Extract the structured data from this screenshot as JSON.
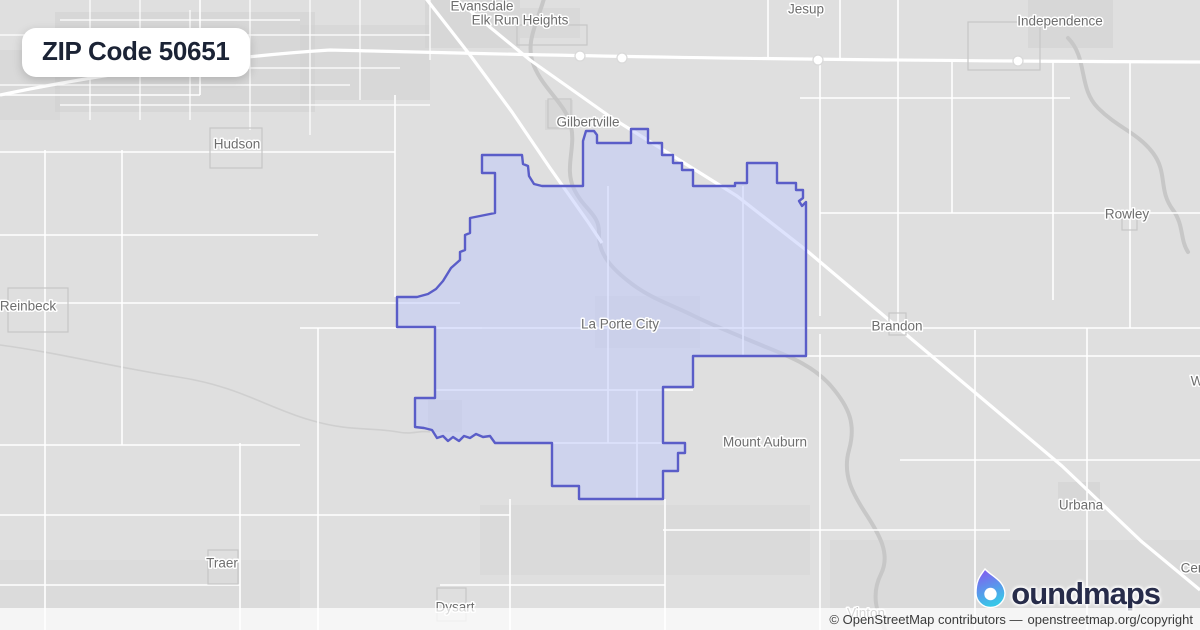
{
  "badge": {
    "title": "ZIP Code 50651"
  },
  "attribution": {
    "text": "© OpenStreetMap contributors —",
    "link": "openstreetmap.org/copyright"
  },
  "logo": {
    "brand": "boundmaps",
    "wordmark_rest": "oundmaps"
  },
  "map_data": {
    "colors": {
      "background": "#dfdfdf",
      "road": "#ffffff",
      "river": "#c7c7c7",
      "creek": "#cfcfcf",
      "town_outline": "#c6c6c6",
      "label": "#6e6e6e",
      "zip_fill": "#bec8fc",
      "zip_stroke": "#5a5dc8",
      "logo_navy": "#272c4a",
      "logo_purple": "#8a53f0",
      "logo_cyan": "#38c6e8"
    },
    "zip_boundary": {
      "name": "ZIP 50651 boundary",
      "fill_opacity": 0.5,
      "stroke_width": 2.4,
      "points": [
        [
          482,
          155
        ],
        [
          522,
          155
        ],
        [
          523,
          164
        ],
        [
          528,
          166
        ],
        [
          529,
          176
        ],
        [
          534,
          184
        ],
        [
          542,
          186
        ],
        [
          583,
          186
        ],
        [
          583,
          141
        ],
        [
          586,
          131
        ],
        [
          594,
          131
        ],
        [
          597,
          135
        ],
        [
          597,
          143
        ],
        [
          631,
          143
        ],
        [
          631,
          129
        ],
        [
          648,
          129
        ],
        [
          648,
          143
        ],
        [
          662,
          143
        ],
        [
          662,
          155
        ],
        [
          673,
          155
        ],
        [
          673,
          163
        ],
        [
          682,
          163
        ],
        [
          682,
          170
        ],
        [
          693,
          170
        ],
        [
          693,
          186
        ],
        [
          735,
          186
        ],
        [
          735,
          183
        ],
        [
          747,
          183
        ],
        [
          747,
          163
        ],
        [
          777,
          163
        ],
        [
          777,
          183
        ],
        [
          796,
          183
        ],
        [
          796,
          190
        ],
        [
          803,
          190
        ],
        [
          803,
          198
        ],
        [
          799,
          201
        ],
        [
          802,
          206
        ],
        [
          806,
          202
        ],
        [
          806,
          356
        ],
        [
          693,
          356
        ],
        [
          693,
          387
        ],
        [
          663,
          387
        ],
        [
          663,
          443
        ],
        [
          685,
          443
        ],
        [
          685,
          453
        ],
        [
          678,
          453
        ],
        [
          678,
          471
        ],
        [
          663,
          471
        ],
        [
          663,
          499
        ],
        [
          579,
          499
        ],
        [
          579,
          486
        ],
        [
          552,
          486
        ],
        [
          552,
          443
        ],
        [
          495,
          443
        ],
        [
          490,
          436
        ],
        [
          483,
          437
        ],
        [
          476,
          434
        ],
        [
          470,
          438
        ],
        [
          464,
          436
        ],
        [
          459,
          441
        ],
        [
          453,
          437
        ],
        [
          448,
          441
        ],
        [
          443,
          436
        ],
        [
          437,
          438
        ],
        [
          432,
          430
        ],
        [
          424,
          428
        ],
        [
          415,
          427
        ],
        [
          415,
          398
        ],
        [
          435,
          398
        ],
        [
          435,
          327
        ],
        [
          397,
          327
        ],
        [
          397,
          297
        ],
        [
          417,
          297
        ],
        [
          428,
          294
        ],
        [
          436,
          289
        ],
        [
          443,
          281
        ],
        [
          451,
          268
        ],
        [
          460,
          260
        ],
        [
          460,
          252
        ],
        [
          465,
          250
        ],
        [
          465,
          235
        ],
        [
          470,
          233
        ],
        [
          470,
          218
        ],
        [
          495,
          213
        ],
        [
          495,
          173
        ],
        [
          482,
          173
        ]
      ]
    },
    "labels": [
      {
        "t": "Evansdale",
        "x": 482,
        "y": 6
      },
      {
        "t": "Elk Run Heights",
        "x": 520,
        "y": 20
      },
      {
        "t": "Jesup",
        "x": 806,
        "y": 9
      },
      {
        "t": "Independence",
        "x": 1060,
        "y": 21
      },
      {
        "t": "Gilbertville",
        "x": 588,
        "y": 122
      },
      {
        "t": "Hudson",
        "x": 237,
        "y": 144
      },
      {
        "t": "Rowley",
        "x": 1127,
        "y": 214
      },
      {
        "t": "Reinbeck",
        "x": 28,
        "y": 306
      },
      {
        "t": "La Porte City",
        "x": 620,
        "y": 324
      },
      {
        "t": "Brandon",
        "x": 897,
        "y": 326
      },
      {
        "t": "Mount Auburn",
        "x": 765,
        "y": 442
      },
      {
        "t": "Urbana",
        "x": 1081,
        "y": 505
      },
      {
        "t": "Traer",
        "x": 222,
        "y": 563
      },
      {
        "t": "Dysart",
        "x": 455,
        "y": 607
      },
      {
        "t": "Vinton",
        "x": 866,
        "y": 613
      },
      {
        "t": "Cen",
        "x": 1193,
        "y": 568
      },
      {
        "t": "W",
        "x": 1197,
        "y": 381
      }
    ],
    "patches": [
      [
        55,
        12,
        260,
        100,
        0.55
      ],
      [
        300,
        25,
        130,
        75,
        0.45
      ],
      [
        0,
        50,
        60,
        70,
        0.4
      ],
      [
        425,
        0,
        95,
        48,
        0.5
      ],
      [
        520,
        8,
        60,
        30,
        0.4
      ],
      [
        1028,
        0,
        85,
        48,
        0.5
      ],
      [
        545,
        100,
        28,
        30,
        0.5
      ],
      [
        595,
        296,
        105,
        52,
        0.45
      ],
      [
        428,
        400,
        34,
        32,
        0.5
      ],
      [
        1058,
        482,
        42,
        28,
        0.5
      ],
      [
        480,
        505,
        330,
        70,
        0.3
      ],
      [
        830,
        540,
        370,
        88,
        0.3
      ],
      [
        0,
        560,
        300,
        70,
        0.25
      ]
    ],
    "town_outlines": [
      [
        210,
        128,
        52,
        40
      ],
      [
        8,
        288,
        60,
        44
      ],
      [
        1122,
        214,
        15,
        16
      ],
      [
        889,
        313,
        17,
        22
      ],
      [
        208,
        550,
        30,
        34
      ],
      [
        437,
        588,
        29,
        33
      ],
      [
        548,
        99,
        23,
        29
      ],
      [
        968,
        22,
        72,
        48
      ],
      [
        517,
        25,
        70,
        20
      ]
    ],
    "roads": {
      "vertical": [
        [
          45,
          150,
          630
        ],
        [
          122,
          150,
          445
        ],
        [
          200,
          0,
          95
        ],
        [
          240,
          443,
          630
        ],
        [
          318,
          328,
          630
        ],
        [
          395,
          95,
          297
        ],
        [
          510,
          499,
          630
        ],
        [
          608,
          186,
          443
        ],
        [
          637,
          390,
          499
        ],
        [
          665,
          499,
          630
        ],
        [
          743,
          186,
          356
        ],
        [
          820,
          62,
          316
        ],
        [
          820,
          334,
          630
        ],
        [
          898,
          0,
          330
        ],
        [
          975,
          330,
          630
        ],
        [
          1053,
          62,
          300
        ],
        [
          1087,
          328,
          630
        ],
        [
          1130,
          62,
          328
        ],
        [
          768,
          0,
          58
        ],
        [
          840,
          0,
          58
        ],
        [
          952,
          62,
          213
        ]
      ],
      "horizontal": [
        [
          95,
          0,
          200
        ],
        [
          152,
          0,
          395
        ],
        [
          213,
          820,
          1200
        ],
        [
          235,
          0,
          318
        ],
        [
          98,
          800,
          1070
        ],
        [
          303,
          0,
          460
        ],
        [
          328,
          300,
          482
        ],
        [
          328,
          435,
          806
        ],
        [
          328,
          806,
          1200
        ],
        [
          356,
          806,
          1200
        ],
        [
          390,
          435,
          693
        ],
        [
          445,
          0,
          300
        ],
        [
          443,
          520,
          663
        ],
        [
          460,
          900,
          1200
        ],
        [
          515,
          0,
          510
        ],
        [
          530,
          663,
          1010
        ],
        [
          585,
          0,
          240
        ],
        [
          585,
          440,
          665
        ]
      ],
      "urban_vertical": [
        [
          90,
          0,
          120
        ],
        [
          140,
          0,
          120
        ],
        [
          190,
          10,
          120
        ],
        [
          250,
          0,
          130
        ],
        [
          310,
          0,
          135
        ],
        [
          360,
          0,
          100
        ],
        [
          430,
          0,
          60
        ]
      ],
      "urban_horizontal": [
        [
          20,
          60,
          300
        ],
        [
          35,
          0,
          430
        ],
        [
          68,
          30,
          400
        ],
        [
          85,
          0,
          350
        ],
        [
          105,
          60,
          430
        ]
      ]
    },
    "highways": [
      "M 452,-4 L 530,60 L 612,118 L 665,151 L 737,196 L 806,250 L 902,331 L 985,401 L 1062,466 L 1141,541 L 1200,590",
      "M 424,-4 L 470,55 L 512,112 L 550,168 L 588,222 L 602,243",
      "M 0,95 C 120,70 250,55 330,50 C 500,54 700,60 1200,62"
    ],
    "rivers": [
      "M 545,-5 C 538,22 524,42 534,66 C 544,90 566,104 571,126 C 576,148 564,168 574,189 C 584,210 600,214 599,234 C 598,254 612,269 632,284 C 652,299 672,305 692,315 C 712,325 737,335 761,345 C 785,355 812,364 831,386 C 850,408 856,425 849,450 C 842,475 853,494 866,514 C 879,534 891,554 881,574 C 871,594 876,612 886,632",
      "M 1068,38 C 1088,58 1078,88 1098,108 C 1118,128 1138,133 1153,153 C 1168,173 1158,190 1173,210 C 1184,225 1180,240 1188,252"
    ],
    "creeks": [
      "M 0,345 C 60,353 118,368 178,377 C 238,386 268,408 310,420 C 350,432 372,427 398,432 C 412,435 420,430 430,432"
    ],
    "interchanges": [
      [
        580,
        56
      ],
      [
        622,
        58
      ],
      [
        818,
        60
      ],
      [
        1018,
        61
      ]
    ]
  }
}
